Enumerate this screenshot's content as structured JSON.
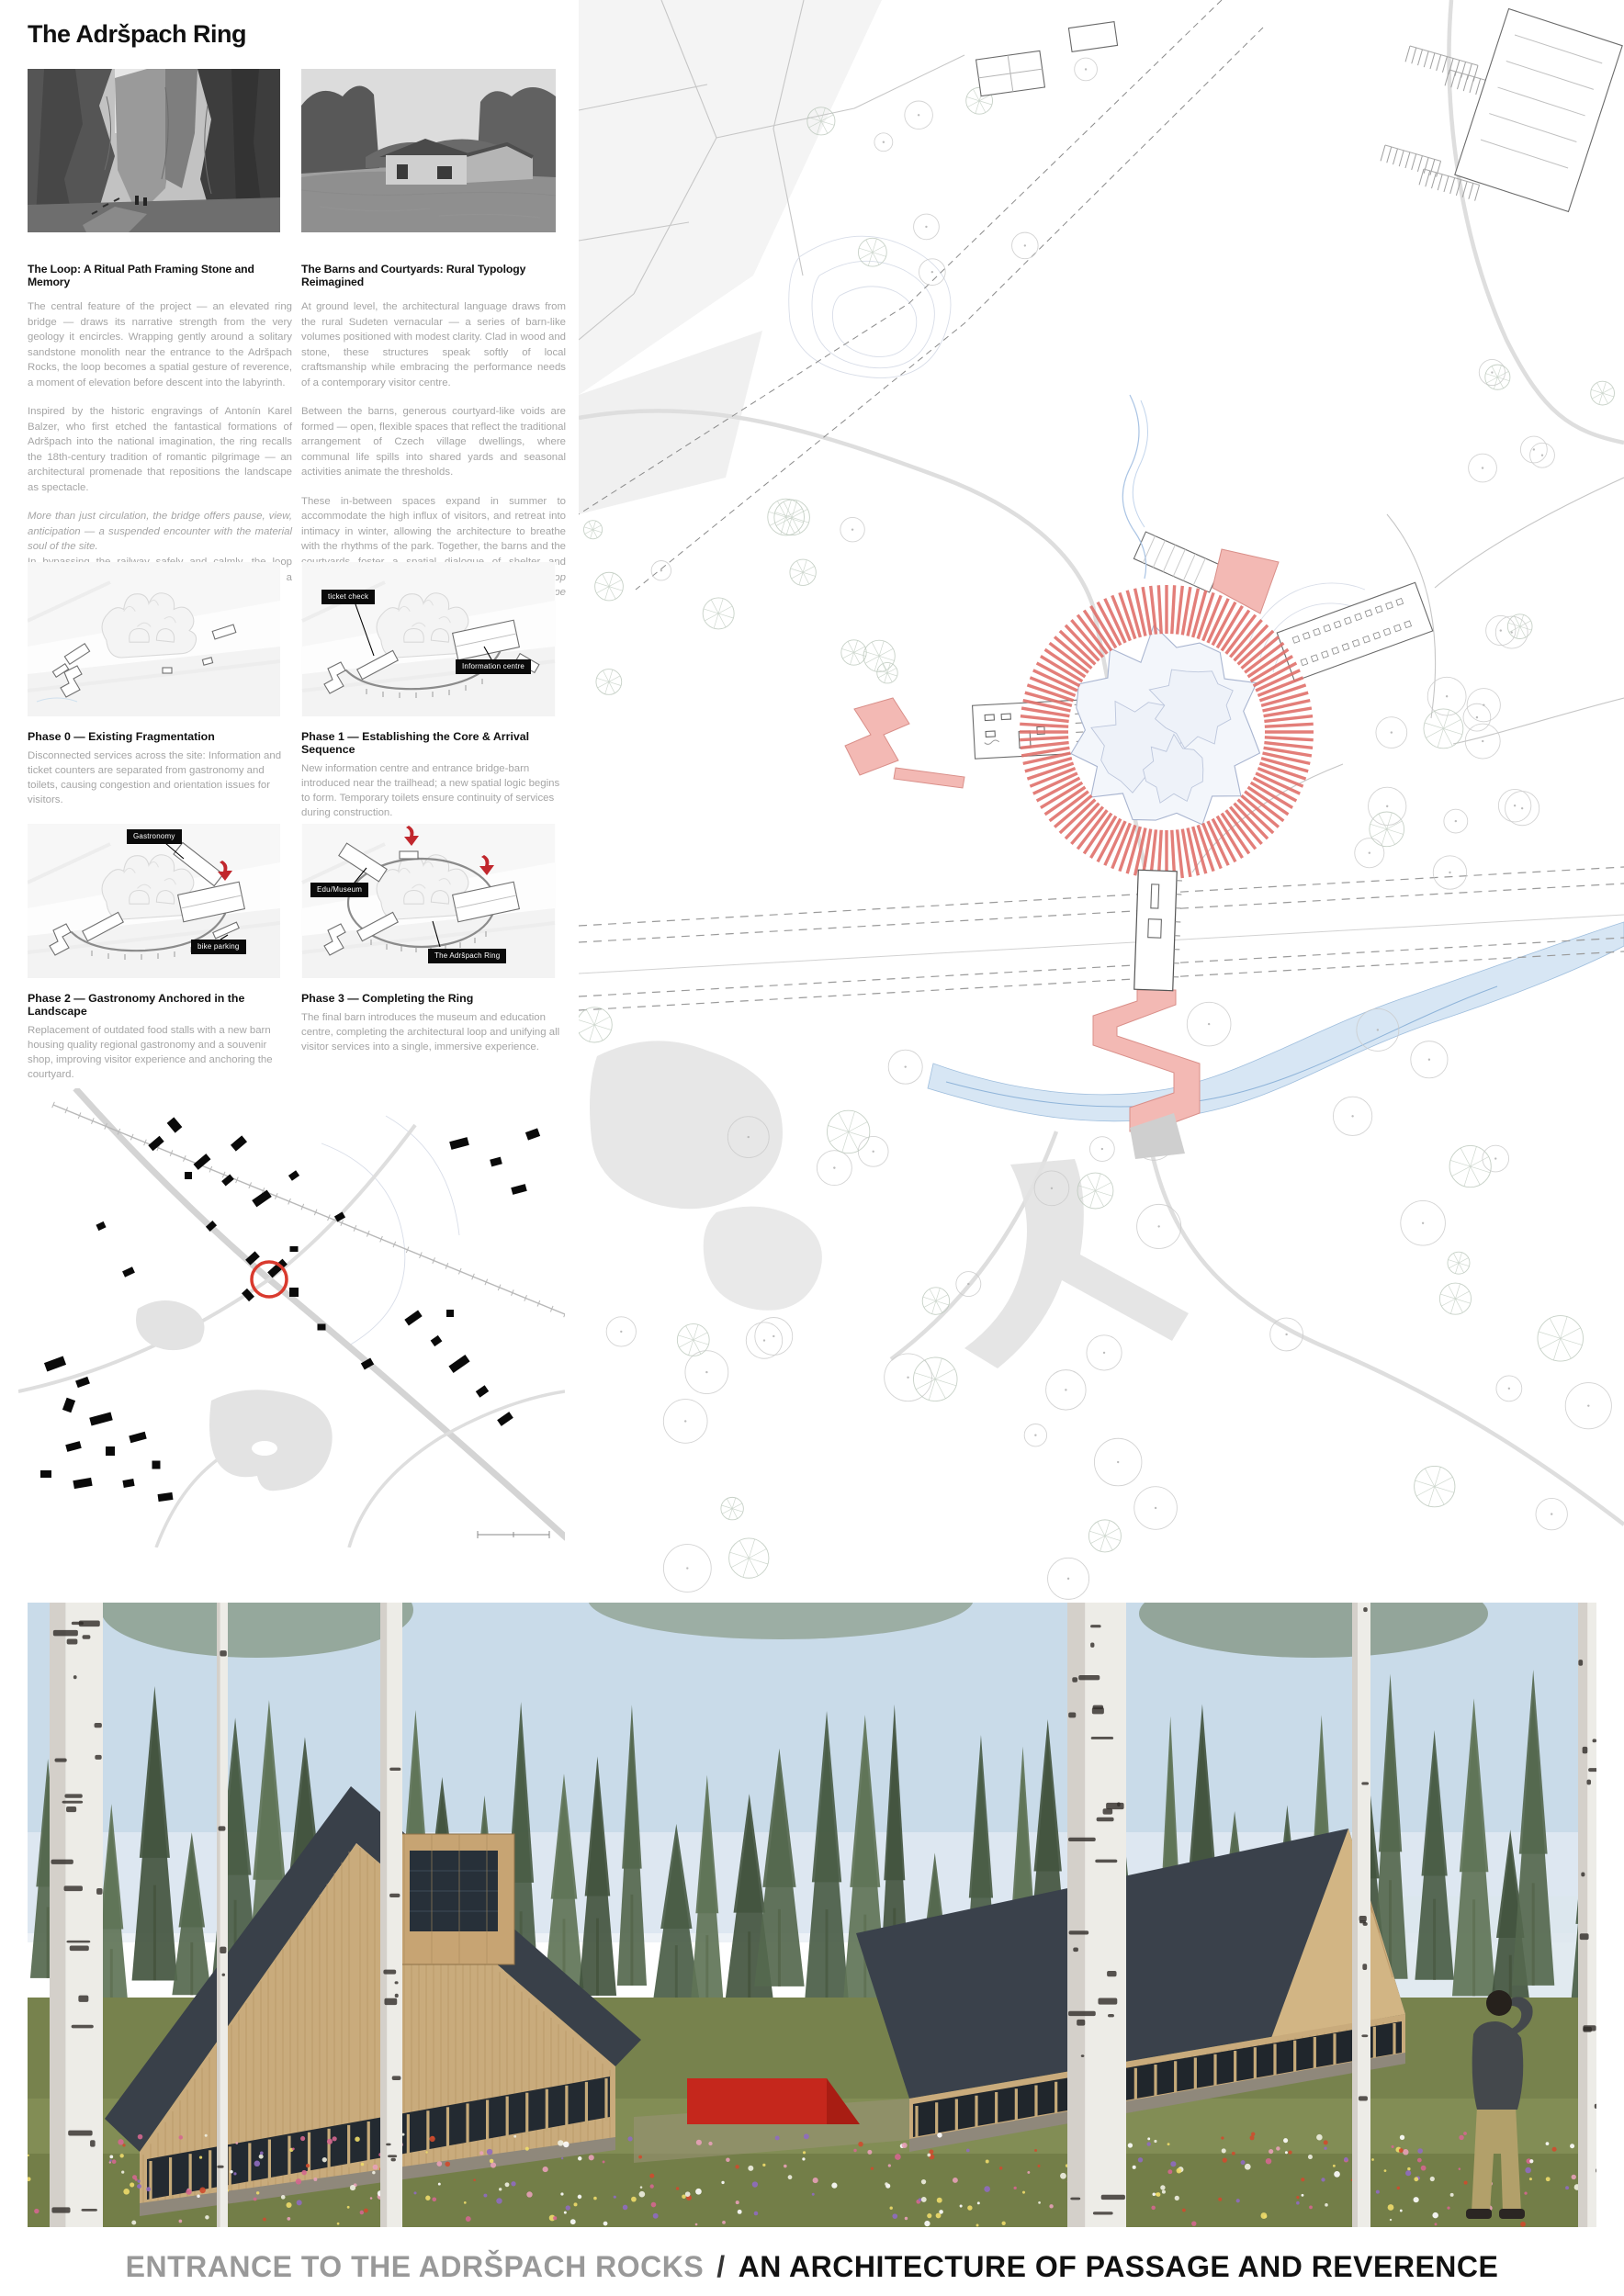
{
  "board": {
    "title": "The Adršpach Ring"
  },
  "columns": [
    {
      "heading": "The Loop: A Ritual Path Framing Stone and Memory",
      "paras": [
        {
          "segs": [
            {
              "t": "The central feature of the project — an elevated ring bridge — draws its narrative strength from the very geology it encircles. Wrapping gently around a solitary sandstone monolith near the entrance to the Adršpach Rocks, the loop becomes a spatial gesture of reverence, a moment of elevation before descent into the labyrinth."
            }
          ]
        },
        {
          "segs": [
            {
              "t": "Inspired by the historic engravings of Antonín Karel Balzer, who first etched the fantastical formations of Adršpach into the national imagination, the ring recalls the 18th-century tradition of romantic pilgrimage — an architectural promenade that repositions the landscape as spectacle."
            }
          ]
        },
        {
          "segs": [
            {
              "t": "More than just circulation, the bridge offers pause, view, anticipation — a suspended encounter with the material soul of the site.",
              "i": true
            }
          ]
        },
        {
          "tight": true,
          "segs": [
            {
              "t": "In bypassing the railway safely and calmly, the loop becomes both a practical and symbolic threshold: a circular breath before the deeper journey."
            }
          ]
        }
      ]
    },
    {
      "heading": "The Barns and Courtyards: Rural Typology Reimagined",
      "paras": [
        {
          "segs": [
            {
              "t": "At ground level, the architectural language draws from the rural Sudeten vernacular — a series of barn-like volumes positioned with modest clarity. Clad in wood and stone, these structures speak softly of local craftsmanship while embracing the performance needs of a contemporary visitor centre."
            }
          ]
        },
        {
          "segs": [
            {
              "t": "Between the barns, generous courtyard-like voids are formed — open, flexible spaces that reflect the traditional arrangement of Czech village dwellings, where communal life spills into shared yards and seasonal activities animate the thresholds."
            }
          ]
        },
        {
          "segs": [
            {
              "t": "These in-between spaces expand in summer to accommodate the high influx of visitors, and retreat into intimacy in winter, allowing the architecture to breathe with the rhythms of the park. Together, the barns and the courtyards foster a spatial dialogue of shelter and exposure — "
            },
            {
              "t": "a humble ensemble unified by the loop above, but grounded deeply in the everyday landscape below.",
              "i": true
            }
          ]
        }
      ]
    }
  ],
  "phases": [
    {
      "title": "Phase 0 — Existing Fragmentation",
      "body": "Disconnected services across the site: Information and ticket counters are separated from gastronomy and toilets, causing congestion and orientation issues for visitors.",
      "labels": []
    },
    {
      "title": "Phase 1 — Establishing the Core & Arrival Sequence",
      "body": "New information centre and entrance bridge-barn introduced near the trailhead; a new spatial logic begins to form. Temporary toilets ensure continuity of services during construction.",
      "labels": [
        {
          "text": "ticket check"
        },
        {
          "text": "Information centre"
        }
      ]
    },
    {
      "title": "Phase 2 — Gastronomy Anchored in the Landscape",
      "body": "Replacement of outdated food stalls with a new barn housing quality regional gastronomy and a souvenir shop, improving visitor experience and anchoring the courtyard.",
      "labels": [
        {
          "text": "Gastronomy"
        },
        {
          "text": "bike parking"
        }
      ]
    },
    {
      "title": "Phase 3 — Completing the Ring",
      "body": "The final barn introduces the museum and education centre, completing the architectural loop and unifying all visitor services into a single, immersive experience.",
      "labels": [
        {
          "text": "Edu/Museum"
        },
        {
          "text": "The Adršpach Ring"
        }
      ]
    }
  ],
  "footer": {
    "left": "ENTRANCE TO THE ADRŠPACH ROCKS",
    "sep": "/",
    "right": "AN ARCHITECTURE OF PASSAGE AND REVERENCE"
  },
  "colors": {
    "ring_red": "#e0716b",
    "pink_fill": "#f3b9b4",
    "arrow_red": "#c1272d",
    "marker_red": "#d93a2e",
    "render_red": "#c5271c",
    "footer_gray": "#999999",
    "ink": "#111111",
    "body_gray": "#a5a5a5",
    "water_blue": "#a9c7e4"
  }
}
